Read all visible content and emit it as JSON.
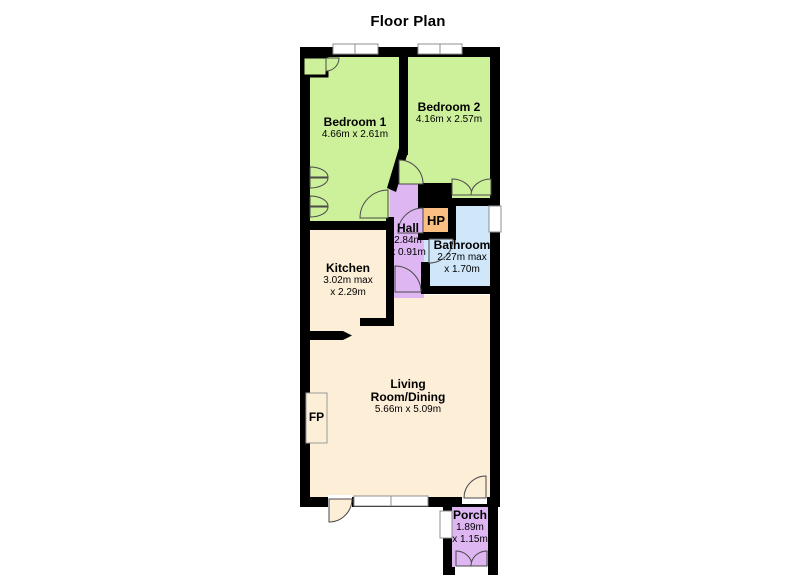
{
  "title": "Floor Plan",
  "rooms": {
    "bedroom1": {
      "label": "Bedroom 1",
      "dims": "4.66m x 2.61m",
      "color": "#cdf09b"
    },
    "bedroom2": {
      "label": "Bedroom 2",
      "dims": "4.16m x 2.57m",
      "color": "#cdf09b"
    },
    "hall": {
      "label": "Hall",
      "dims_line1": "2.84m",
      "dims_line2": "x 0.91m",
      "color": "#ddb6f2"
    },
    "bathroom": {
      "label": "Bathroom",
      "dims_line1": "2.27m max",
      "dims_line2": "x 1.70m",
      "color": "#cfe7f8"
    },
    "kitchen": {
      "label": "Kitchen",
      "dims_line1": "3.02m max",
      "dims_line2": "x 2.29m",
      "color": "#fdeed8"
    },
    "living": {
      "label_line1": "Living",
      "label_line2": "Room/Dining",
      "dims": "5.66m x 5.09m",
      "color": "#fdeed8"
    },
    "porch": {
      "label": "Porch",
      "dims_line1": "1.89m",
      "dims_line2": "x 1.15m",
      "color": "#ddb6f2"
    },
    "hot_press": {
      "label": "HP",
      "color": "#fbbf82"
    },
    "fireplace": {
      "label": "FP",
      "color": "#fdeed8"
    }
  },
  "style": {
    "wall_color": "#000000",
    "window_border": "#8f8f8f",
    "door_arc_stroke": "#4a4a4a",
    "background": "#ffffff"
  }
}
